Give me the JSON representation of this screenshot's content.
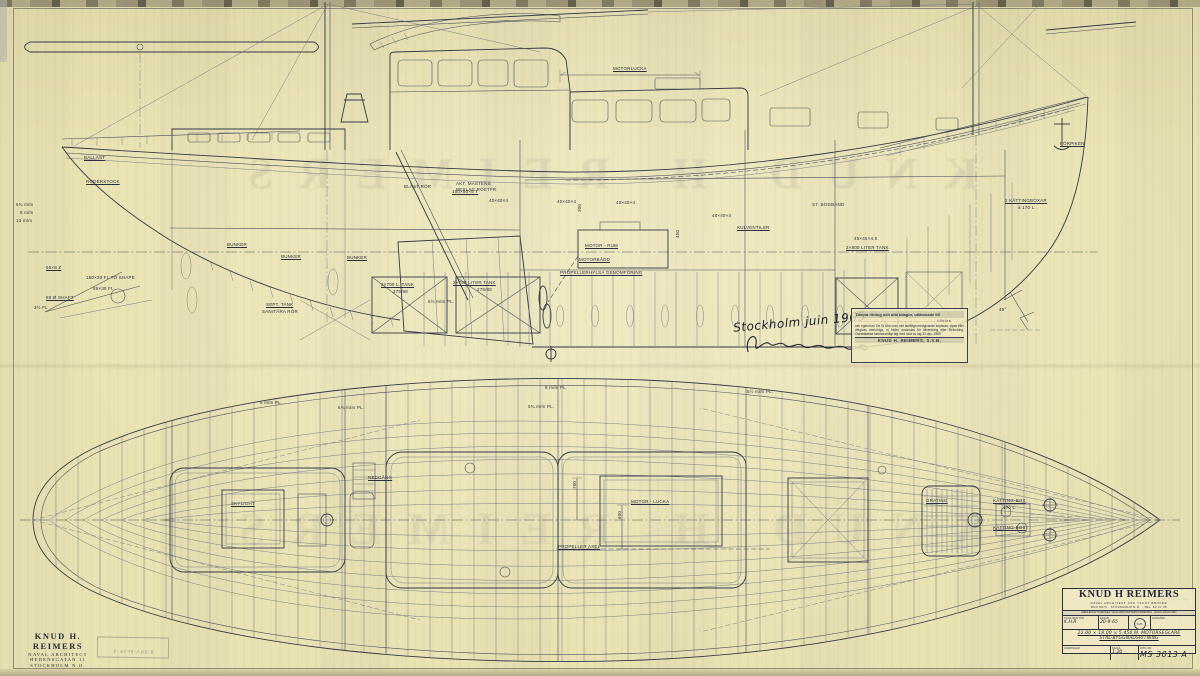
{
  "sheet": {
    "paper_color": "#e9e2b2",
    "ink_color": "#333a4a",
    "ghost_text": "KNUD H REIMERS"
  },
  "handwritten": {
    "place_date": "Stockholm juin 1965",
    "signature_name": "Knud Reimers"
  },
  "copyright_box": {
    "header": "Denna ritning och alla bilagor, utlämnade till",
    "dotted_line": "........................................................  tillhöra",
    "body": "min egendom. De få icke utan mitt skriftliga medgivande kopieras, visas eller delgivas obehöriga, ej heller användas för tillverkning eller förändring. Överträdelse beivras enligt lag med stöd av lag 30 dec. 1960.",
    "footer": "KNUD H. REIMERS, S.V.B."
  },
  "architect_block": {
    "line1": "KNUD H. REIMERS",
    "line2": "NAVAL ARCHITECT",
    "line3": "HEDENSGATAN 11",
    "line4": "STOCKHOLM N.O."
  },
  "museum_stamp": {
    "text": "8:0RV-0L0F-3"
  },
  "title_block": {
    "company": "KNUD H REIMERS",
    "profession": "NAVAL ARCHITECT AND YACHT BROKER",
    "address": "BOX 5073  ·  STOCKHOLM N.Ö.  ·  TEL. 63 27 35",
    "membership": "MEDLEM AV SVERIGES YACHTARKITEKTERS FÖRENING · SACO-ANSLUTEN",
    "fields": [
      {
        "label": "KONSTRUKTÖR",
        "value": "K.H.R."
      },
      {
        "label": "DATUM",
        "value": "20-9-65"
      },
      {
        "label": "GODKÄND",
        "value": ""
      }
    ],
    "stamp_monogram": "SVB",
    "spec_line1": "22.00 × 18.00 × 5.450 M. MOTORSEGLARE",
    "spec_line2": "STÅL-BYGGNADSRITNING",
    "bottom": [
      {
        "label": "ÄNDRINGAR",
        "value": ""
      },
      {
        "label": "SKALA",
        "value": "1:20"
      },
      {
        "label": "RITN. NR.",
        "value": "MS 3013 A"
      }
    ]
  },
  "annotations": [
    {
      "t": "MOTORLUCKA",
      "x": 613,
      "y": 67,
      "u": 1
    },
    {
      "t": "BLÄST RÖR",
      "x": 404,
      "y": 185
    },
    {
      "t": "100×50×5 T",
      "x": 452,
      "y": 190,
      "u": 1
    },
    {
      "t": "40×40×4",
      "x": 489,
      "y": 199
    },
    {
      "t": "40×40×4",
      "x": 557,
      "y": 200
    },
    {
      "t": "40×40×4",
      "x": 616,
      "y": 201
    },
    {
      "t": "40×40×4",
      "x": 712,
      "y": 214
    },
    {
      "t": "AKT. MASTENS",
      "x": 456,
      "y": 182
    },
    {
      "t": "BESLAG ROSTFR.",
      "x": 456,
      "y": 188
    },
    {
      "t": "BALLAST",
      "x": 84,
      "y": 156,
      "u": 1
    },
    {
      "t": "RODERSTOCK",
      "x": 86,
      "y": 180,
      "u": 1
    },
    {
      "t": "KULVENTILER",
      "x": 737,
      "y": 226,
      "u": 1
    },
    {
      "t": "ST. BOGBAND",
      "x": 812,
      "y": 203
    },
    {
      "t": "MOTOR - RUM",
      "x": 585,
      "y": 244,
      "u": 1
    },
    {
      "t": "MOTORBÄDD",
      "x": 579,
      "y": 258,
      "u": 1
    },
    {
      "t": "PROPELLERHYLSA GENOMFÖRING",
      "x": 560,
      "y": 271,
      "u": 1
    },
    {
      "t": "2×700 L. TANK",
      "x": 381,
      "y": 283,
      "u": 1
    },
    {
      "t": "275/88",
      "x": 393,
      "y": 290
    },
    {
      "t": "2×750 LITER TANK",
      "x": 453,
      "y": 281,
      "u": 1
    },
    {
      "t": "275/88",
      "x": 477,
      "y": 288
    },
    {
      "t": "6½ m/m PL.",
      "x": 428,
      "y": 300
    },
    {
      "t": "2×800 LITER TANK",
      "x": 846,
      "y": 246,
      "u": 1
    },
    {
      "t": "45×45×4.5",
      "x": 854,
      "y": 237
    },
    {
      "t": "2 KÄTTINGBOXAR",
      "x": 1005,
      "y": 199,
      "u": 1
    },
    {
      "t": "à 170 L.",
      "x": 1018,
      "y": 206
    },
    {
      "t": "FÖRPIKEN",
      "x": 1060,
      "y": 142,
      "u": 1
    },
    {
      "t": "BUNKER",
      "x": 227,
      "y": 243,
      "u": 1
    },
    {
      "t": "BUNKER",
      "x": 281,
      "y": 255,
      "u": 1
    },
    {
      "t": "BUNKER",
      "x": 347,
      "y": 256,
      "u": 1
    },
    {
      "t": "SEPT. TANK",
      "x": 266,
      "y": 303,
      "u": 1
    },
    {
      "t": "SANITÄRA RÖR",
      "x": 262,
      "y": 310
    },
    {
      "t": "5¾ m/m",
      "x": 16,
      "y": 203
    },
    {
      "t": "8 m/m",
      "x": 20,
      "y": 211
    },
    {
      "t": "13 m/m",
      "x": 16,
      "y": 219
    },
    {
      "t": "65×8 Z",
      "x": 46,
      "y": 266,
      "u": 1
    },
    {
      "t": "150×20 FL TO SHAPE",
      "x": 86,
      "y": 276
    },
    {
      "t": "85×30 FL",
      "x": 93,
      "y": 287
    },
    {
      "t": "80 Ø SHAFT",
      "x": 46,
      "y": 296,
      "u": 1
    },
    {
      "t": "3½ FL",
      "x": 34,
      "y": 306
    },
    {
      "t": "300",
      "x": 578,
      "y": 212,
      "r": -90
    },
    {
      "t": "450",
      "x": 676,
      "y": 238,
      "r": -90
    },
    {
      "t": "45°",
      "x": 999,
      "y": 308
    },
    {
      "t": "8 m/m PL.",
      "x": 545,
      "y": 386
    },
    {
      "t": "5¾ m/m PL.",
      "x": 528,
      "y": 405
    },
    {
      "t": "6¾ m/m PL.",
      "x": 338,
      "y": 406
    },
    {
      "t": "5 m/m PL.",
      "x": 260,
      "y": 401
    },
    {
      "t": "5½ m/m PL.",
      "x": 747,
      "y": 390
    },
    {
      "t": "SKYLIGHT",
      "x": 231,
      "y": 502,
      "u": 1
    },
    {
      "t": "NEDGÅNG",
      "x": 368,
      "y": 476,
      "u": 1
    },
    {
      "t": "MOTOR - LUCKA",
      "x": 631,
      "y": 500,
      "u": 1
    },
    {
      "t": "PROPELLER AXEL",
      "x": 558,
      "y": 545,
      "u": 1
    },
    {
      "t": "KÄTTING-BOX",
      "x": 993,
      "y": 499,
      "u": 1
    },
    {
      "t": "170 L.",
      "x": 1003,
      "y": 506
    },
    {
      "t": "KÄTTING-BOX",
      "x": 993,
      "y": 526,
      "u": 1
    },
    {
      "t": "GRATING",
      "x": 926,
      "y": 499,
      "u": 1
    },
    {
      "t": "700",
      "x": 573,
      "y": 489,
      "r": -90
    },
    {
      "t": "600",
      "x": 618,
      "y": 519,
      "r": -90
    }
  ]
}
